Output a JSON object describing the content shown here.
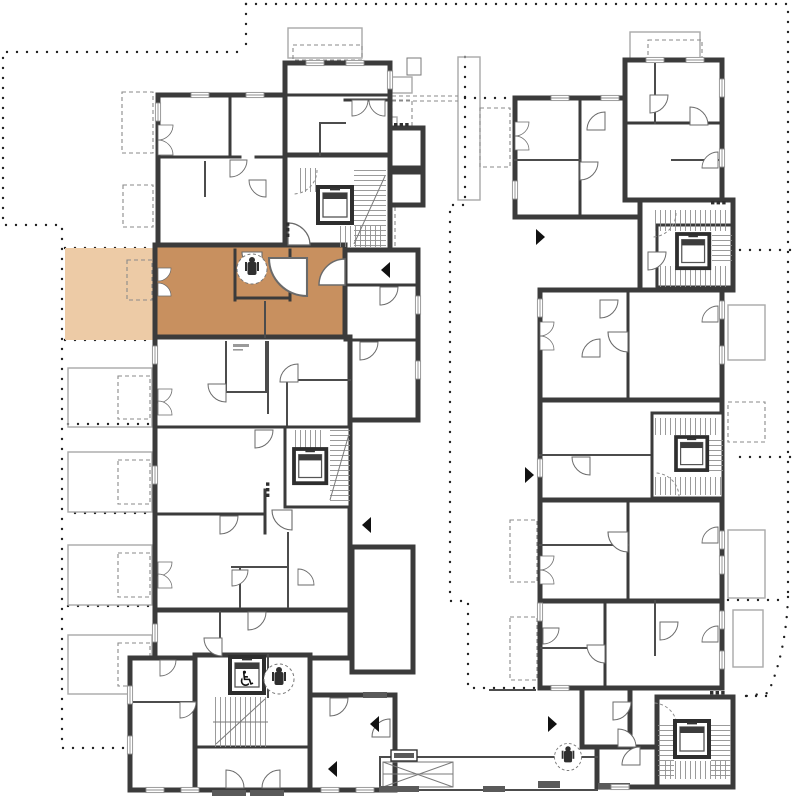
{
  "document": {
    "type": "architectural floor plan",
    "description": "Upper-floor plan of a residential complex with two apartment wings, stair cores with elevators, a connecting walkway at the bottom, and one apartment unit highlighted in orange with its terrace highlighted in light orange",
    "view": "top-down plan view"
  },
  "highlight": {
    "name": "selected apartment unit",
    "unit_fill": "#c8905f",
    "terrace_fill": "#edcba6",
    "location": "left wing, upper middle",
    "has_terrace": true
  },
  "colors": {
    "background": "#ffffff",
    "walls": "#3b3b3b",
    "interior_walls": "#4c4c4c",
    "site_boundary_dots": "#1f1f1f",
    "light_outline": "#a9a9a9",
    "dashed_outline": "#8a8a8a",
    "stair_treads": "#909090",
    "mats": "#5a5a5a"
  },
  "icons": {
    "wheelchair_glyph": "♿",
    "wheelchair": "wheelchair-accessible-elevator",
    "elevator": "elevator-car",
    "fixture": "plumbing-fixture-in-dashed-circle",
    "entrance_marker": "black-triangle-entrance-arrow"
  },
  "counts": {
    "elevators": 6,
    "stair_cores": 6,
    "entrance_arrows": 7,
    "fixture_icons": 3
  }
}
